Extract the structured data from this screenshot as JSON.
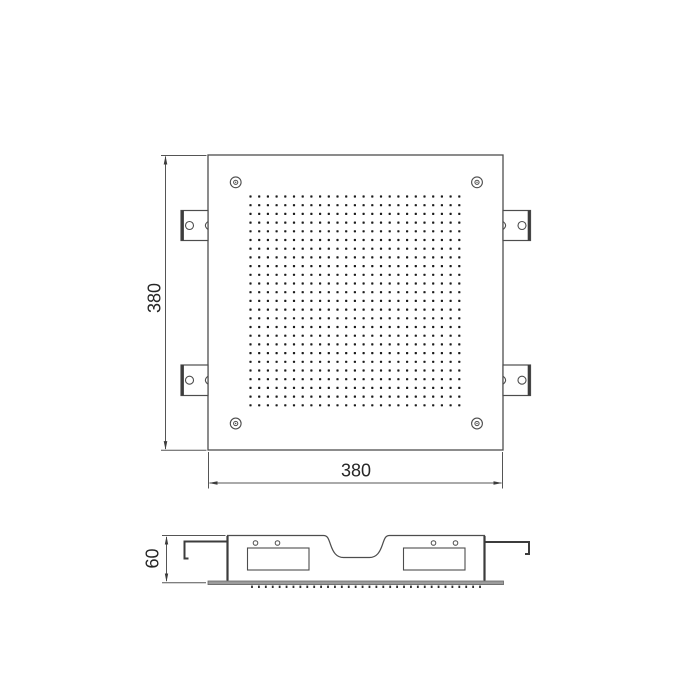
{
  "labels": {
    "top_view_height": "380",
    "top_view_width": "380",
    "side_view_height": "60"
  },
  "top_view": {
    "spray_holes": {
      "rows": 25,
      "cols": 25
    },
    "corner_screw_count": 4,
    "mounting_bracket_count": 4
  },
  "side_view": {
    "nozzle_tick_count": 34,
    "bracket_hole_count": 4
  },
  "colors": {
    "line": "#4d4d4d",
    "dark_line": "#3c3c3c",
    "hole_dot": "#1b1b1b",
    "face_plate_bar": "#9c9c9c",
    "face_plate_edge": "#666666",
    "background": "#ffffff"
  }
}
